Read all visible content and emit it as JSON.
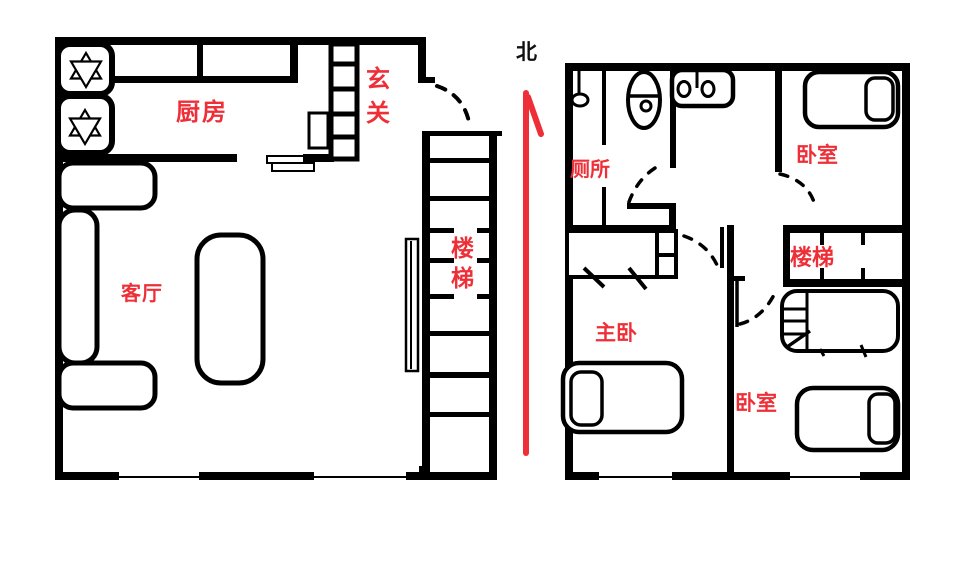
{
  "colors": {
    "ink": "#000000",
    "accent_red": "#ee2f38",
    "background": "#ffffff"
  },
  "compass": {
    "north_label": "北"
  },
  "floor1": {
    "labels": {
      "kitchen": "厨房",
      "entry": "玄关",
      "living_room": "客厅",
      "stairs": "楼梯"
    }
  },
  "floor2": {
    "labels": {
      "toilet": "厕所",
      "bedroom_top": "卧室",
      "master_bedroom": "主卧",
      "stairs": "楼梯",
      "bedroom_bottom": "卧室"
    }
  }
}
